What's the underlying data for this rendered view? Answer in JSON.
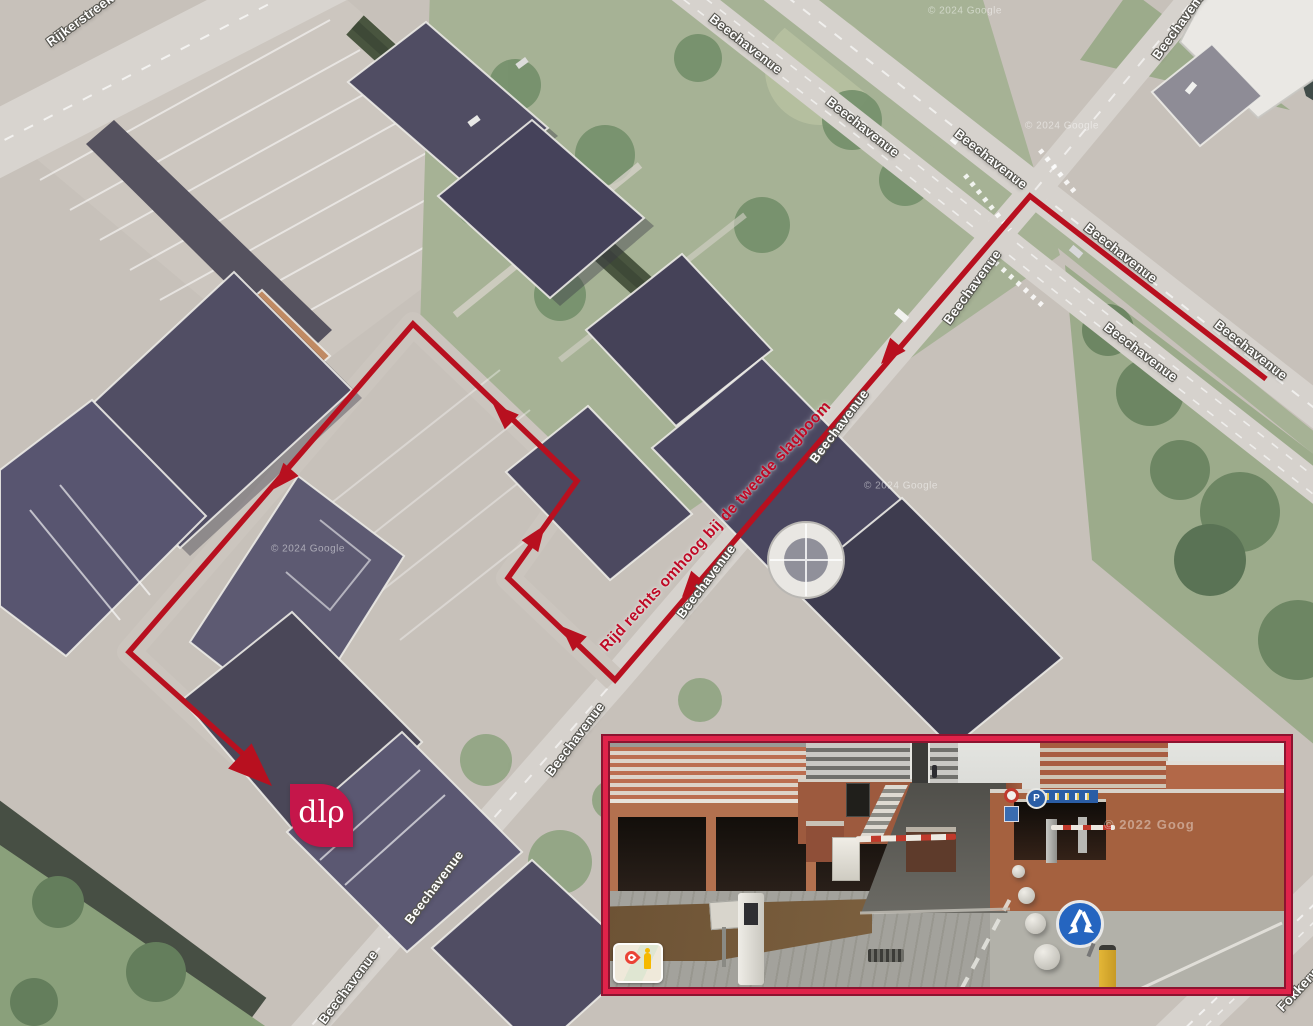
{
  "map": {
    "street_labels": [
      {
        "text": "Rijkerstreek",
        "x": 80,
        "y": 20,
        "rot": -36
      },
      {
        "text": "Beechavenue",
        "x": 746,
        "y": 44,
        "rot": 38
      },
      {
        "text": "Beechavenue",
        "x": 863,
        "y": 127,
        "rot": 38
      },
      {
        "text": "Beechavenue",
        "x": 991,
        "y": 159,
        "rot": 38
      },
      {
        "text": "Beechavenue",
        "x": 1181,
        "y": 22,
        "rot": -54
      },
      {
        "text": "Beechavenue",
        "x": 1121,
        "y": 253,
        "rot": 38
      },
      {
        "text": "Beechavenue",
        "x": 972,
        "y": 287,
        "rot": -54
      },
      {
        "text": "Beechavenue",
        "x": 1141,
        "y": 352,
        "rot": 37
      },
      {
        "text": "Beechavenue",
        "x": 1251,
        "y": 350,
        "rot": 38
      },
      {
        "text": "Beechavenue",
        "x": 839,
        "y": 426,
        "rot": -53
      },
      {
        "text": "Beechavenue",
        "x": 706,
        "y": 581,
        "rot": -53
      },
      {
        "text": "Beechavenue",
        "x": 575,
        "y": 739,
        "rot": -53
      },
      {
        "text": "Beechavenue",
        "x": 434,
        "y": 887,
        "rot": -53
      },
      {
        "text": "Beechavenue",
        "x": 348,
        "y": 987,
        "rot": -53
      },
      {
        "text": "Fokkerweg",
        "x": 1304,
        "y": 983,
        "rot": -47
      }
    ],
    "watermarks": [
      {
        "text": "© 2024 Google",
        "x": 965,
        "y": 11
      },
      {
        "text": "© 2024 Google",
        "x": 1062,
        "y": 126
      },
      {
        "text": "© 2024 Google",
        "x": 308,
        "y": 549
      },
      {
        "text": "© 2024 Google",
        "x": 901,
        "y": 486
      }
    ],
    "route": {
      "color": "#b8101f",
      "points": [
        [
          1266,
          379
        ],
        [
          1030,
          196
        ],
        [
          615,
          680
        ],
        [
          508,
          578
        ],
        [
          577,
          481
        ],
        [
          413,
          324
        ],
        [
          129,
          652
        ],
        [
          252,
          762
        ]
      ],
      "arrows": [
        {
          "x": 881,
          "y": 364,
          "deg": 130.6,
          "size": 26
        },
        {
          "x": 682,
          "y": 597,
          "deg": 130.6,
          "size": 26
        },
        {
          "x": 561,
          "y": 626,
          "deg": -136.4,
          "size": 26
        },
        {
          "x": 545,
          "y": 525,
          "deg": -54.6,
          "size": 26
        },
        {
          "x": 493,
          "y": 404,
          "deg": -136.3,
          "size": 26
        },
        {
          "x": 274,
          "y": 489,
          "deg": 130.9,
          "size": 26
        },
        {
          "x": 272,
          "y": 786,
          "deg": 43.1,
          "size": 44
        }
      ],
      "annotation": {
        "text": "Rijd rechts omhoog bij de tweede slagboom",
        "x": 716,
        "y": 527,
        "rot": -47.5,
        "color": "#bf0a26"
      }
    },
    "marker": {
      "text": "dlρ",
      "x": 321,
      "y": 815,
      "bg": "#c5164a",
      "fg": "#ffffff"
    }
  },
  "inset": {
    "frame_color": "#e0234a",
    "frame_line_color": "#8c1430",
    "watermark": "© 2022 Goog",
    "p_sign": "P",
    "icons": {
      "badge": "google-maps-pin-pegman-badge",
      "blue_sign": "pass-either-side-sign",
      "p_roundel": "parking-sign",
      "red_roundel": "clearance-sign"
    }
  }
}
